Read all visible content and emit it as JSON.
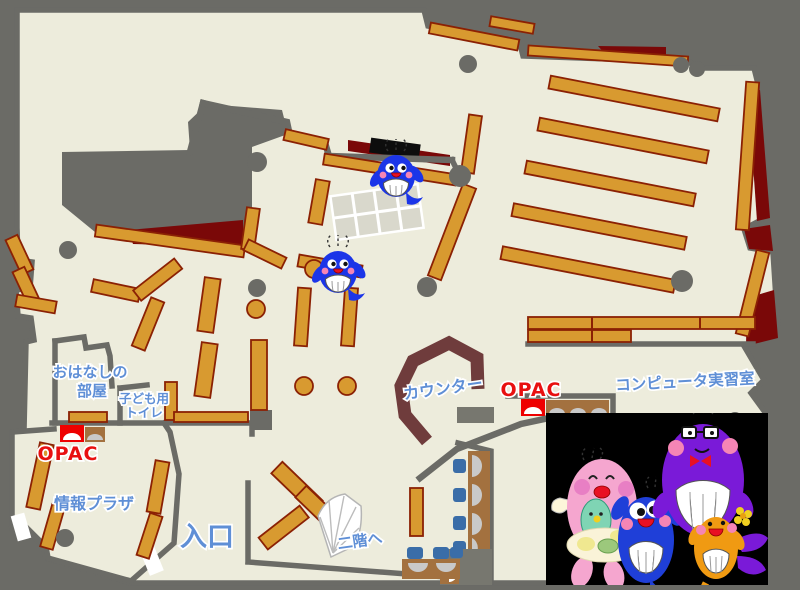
{
  "map": {
    "title": "library-first-floor-map",
    "labels": {
      "story_room_line1": "おはなしの",
      "story_room_line2": "部屋",
      "kids_toilet_line1": "子ども用",
      "kids_toilet_line2": "トイレ",
      "opac_left": "OPAC",
      "opac_right": "OPAC",
      "info_plaza": "情報プラザ",
      "entrance": "入口",
      "counter": "カウンター",
      "to_second_floor": "二階へ",
      "computer_room": "コンピュータ実習室"
    },
    "colors": {
      "floor": "#edecdc",
      "wall_and_outside": "#6b6b66",
      "bookshelf": "#d89a30",
      "bookshelf_border": "#8b2104",
      "closed_area_dark_red": "#7a0808",
      "counter_brown": "#6f3c3c",
      "label_blue": "#5f8fd6",
      "opac_red": "#e81010",
      "table_wood": "#a3713f",
      "chair_blue": "#3a6da8",
      "photo_background": "#000000"
    },
    "icons": {
      "whale_mascot": "blue whale library character",
      "mascot_photo": "four whale mascots (pink, blue, purple, orange)"
    }
  }
}
